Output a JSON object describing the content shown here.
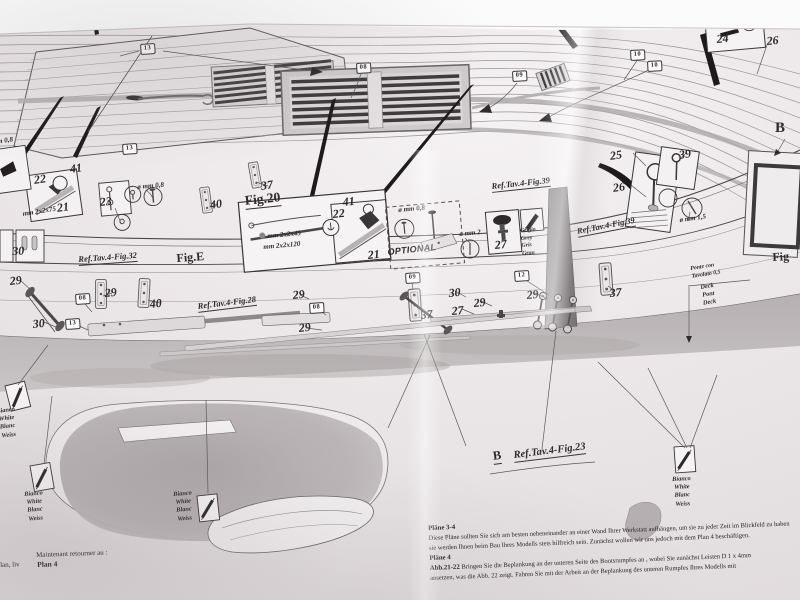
{
  "meta": {
    "description": "Photo of a model-ship construction plan sheet (Plan 3-4)"
  },
  "colors": {
    "background": "#fbfbfb",
    "paper": "#ece7e9",
    "paper_light": "#f5f2f3",
    "ink": "#3a3637",
    "grating_dark": "#3f3b3c",
    "hull_band_gray": "#b8b2b4",
    "shaded_blob_gray": "#b0aaac"
  },
  "labels": [
    {
      "t": "13",
      "x": 140,
      "y": 44,
      "rot": -4,
      "cls": "pbox"
    },
    {
      "t": "08",
      "x": 356,
      "y": 63,
      "rot": -3,
      "cls": "pbox"
    },
    {
      "t": "09",
      "x": 512,
      "y": 71,
      "rot": -3,
      "cls": "pbox"
    },
    {
      "t": "10",
      "x": 630,
      "y": 50,
      "rot": -3,
      "cls": "pbox"
    },
    {
      "t": "10",
      "x": 647,
      "y": 61,
      "rot": -3,
      "cls": "pbox"
    },
    {
      "t": "13",
      "x": 122,
      "y": 144,
      "rot": -4,
      "cls": "pbox"
    },
    {
      "t": "08",
      "x": 75,
      "y": 294,
      "rot": -4,
      "cls": "pbox"
    },
    {
      "t": "13",
      "x": 65,
      "y": 319,
      "rot": -4,
      "cls": "pbox"
    },
    {
      "t": "08",
      "x": 309,
      "y": 303,
      "rot": -4,
      "cls": "pbox"
    },
    {
      "t": "09",
      "x": 405,
      "y": 273,
      "rot": -4,
      "cls": "pbox"
    },
    {
      "t": "12",
      "x": 514,
      "y": 271,
      "rot": -4,
      "cls": "pbox"
    },
    {
      "t": "37",
      "x": 260,
      "y": 179,
      "rot": -8,
      "cls": "pnum"
    },
    {
      "t": "40",
      "x": 209,
      "y": 198,
      "rot": -8,
      "cls": "pnum"
    },
    {
      "t": "22",
      "x": 33,
      "y": 173,
      "rot": -8,
      "cls": "pnum"
    },
    {
      "t": "41",
      "x": 69,
      "y": 162,
      "rot": -8,
      "cls": "pnum"
    },
    {
      "t": "21",
      "x": 56,
      "y": 201,
      "rot": -8,
      "cls": "pnum"
    },
    {
      "t": "23",
      "x": 99,
      "y": 195,
      "rot": -6,
      "cls": "pnum"
    },
    {
      "t": "30",
      "x": 12,
      "y": 244,
      "rot": -2,
      "cls": "pnum"
    },
    {
      "t": "41",
      "x": 342,
      "y": 195,
      "rot": -6,
      "cls": "pnum"
    },
    {
      "t": "22",
      "x": 332,
      "y": 207,
      "rot": -6,
      "cls": "pnum"
    },
    {
      "t": "21",
      "x": 367,
      "y": 248,
      "rot": -6,
      "cls": "pnum"
    },
    {
      "t": "27",
      "x": 494,
      "y": 238,
      "rot": -6,
      "cls": "pnum"
    },
    {
      "t": "24",
      "x": 716,
      "y": 32,
      "rot": -5,
      "cls": "pnum"
    },
    {
      "t": "26",
      "x": 766,
      "y": 34,
      "rot": -5,
      "cls": "pnum"
    },
    {
      "t": "25",
      "x": 609,
      "y": 149,
      "rot": -8,
      "cls": "pnum"
    },
    {
      "t": "39",
      "x": 678,
      "y": 148,
      "rot": -8,
      "cls": "pnum"
    },
    {
      "t": "26",
      "x": 612,
      "y": 181,
      "rot": -8,
      "cls": "pnum"
    },
    {
      "t": "29",
      "x": 9,
      "y": 274,
      "rot": -6,
      "cls": "pnum"
    },
    {
      "t": "30",
      "x": 32,
      "y": 317,
      "rot": -6,
      "cls": "pnum"
    },
    {
      "t": "29",
      "x": 104,
      "y": 286,
      "rot": -6,
      "cls": "pnum"
    },
    {
      "t": "40",
      "x": 149,
      "y": 297,
      "rot": -6,
      "cls": "pnum"
    },
    {
      "t": "29",
      "x": 292,
      "y": 288,
      "rot": -6,
      "cls": "pnum"
    },
    {
      "t": "29",
      "x": 298,
      "y": 321,
      "rot": -6,
      "cls": "pnum"
    },
    {
      "t": "37",
      "x": 420,
      "y": 308,
      "rot": -5,
      "cls": "pnum"
    },
    {
      "t": "30",
      "x": 448,
      "y": 286,
      "rot": -5,
      "cls": "pnum"
    },
    {
      "t": "27",
      "x": 451,
      "y": 304,
      "rot": -5,
      "cls": "pnum"
    },
    {
      "t": "29",
      "x": 473,
      "y": 296,
      "rot": -5,
      "cls": "pnum"
    },
    {
      "t": "29",
      "x": 526,
      "y": 288,
      "rot": -5,
      "cls": "pnum"
    },
    {
      "t": "37",
      "x": 609,
      "y": 286,
      "rot": -5,
      "cls": "pnum"
    },
    {
      "t": "ø mm 0,8",
      "x": -14,
      "y": 139,
      "rot": -8,
      "cls": "dim"
    },
    {
      "t": "mm 2x2x75",
      "x": 22,
      "y": 210,
      "rot": -9,
      "cls": "dim"
    },
    {
      "t": "ø mm 0,8",
      "x": 137,
      "y": 183,
      "rot": -5,
      "cls": "dim"
    },
    {
      "t": "mm 2x2x45",
      "x": 267,
      "y": 232,
      "rot": -5,
      "cls": "dim"
    },
    {
      "t": "mm 2x2x120",
      "x": 263,
      "y": 243,
      "rot": -5,
      "cls": "dim"
    },
    {
      "t": "ø mm 0,8",
      "x": 398,
      "y": 206,
      "rot": -5,
      "cls": "dim"
    },
    {
      "t": "ø mm 2",
      "x": 459,
      "y": 230,
      "rot": -5,
      "cls": "dim"
    },
    {
      "t": "ø mm 1,5",
      "x": 679,
      "y": 216,
      "rot": -8,
      "cls": "dim"
    },
    {
      "t": "Ref.Tav.4-Fig.32",
      "x": 78,
      "y": 254,
      "rot": -4,
      "cls": "ref"
    },
    {
      "t": "Ref.Tav.4-Fig.28",
      "x": 197,
      "y": 301,
      "rot": -7,
      "cls": "ref"
    },
    {
      "t": "Ref.Tav.4-Fig.39",
      "x": 491,
      "y": 181,
      "rot": -6,
      "cls": "ref"
    },
    {
      "t": "Ref.Tav.4-Fig.39",
      "x": 576,
      "y": 226,
      "rot": -11,
      "cls": "ref"
    },
    {
      "t": "Ref.Tav.4-Fig.23",
      "x": 513,
      "y": 450,
      "rot": -7,
      "cls": "ref refbig"
    },
    {
      "t": "Fig.20",
      "x": 244,
      "y": 193,
      "rot": -6,
      "cls": "fig figu"
    },
    {
      "t": "Fig.E",
      "x": 176,
      "y": 251,
      "rot": -4,
      "cls": "fig"
    },
    {
      "t": "Fig",
      "x": 772,
      "y": 250,
      "rot": -3,
      "cls": "fig"
    },
    {
      "t": "B",
      "x": 775,
      "y": 120,
      "rot": 0,
      "cls": "fig bbig"
    },
    {
      "t": "B",
      "x": 492,
      "y": 449,
      "rot": -7,
      "cls": "fig bmid"
    },
    {
      "t": "OPTIONAL",
      "x": 387,
      "y": 247,
      "rot": -6,
      "cls": "opt"
    },
    {
      "t": "Grigio\nGrey\nGris\nGrau",
      "x": 520,
      "y": 228,
      "rot": -5,
      "cls": "colorlbl tleft small"
    },
    {
      "t": "Bianco\nWhite\nBlanc\nWeiss",
      "x": -4,
      "y": 408,
      "rot": -7,
      "cls": "colorlbl"
    },
    {
      "t": "Bianco\nWhite\nBlanc\nWeiss",
      "x": 24,
      "y": 491,
      "rot": -5,
      "cls": "colorlbl"
    },
    {
      "t": "Bianco\nWhite\nBlanc\nWeiss",
      "x": 173,
      "y": 491,
      "rot": -5,
      "cls": "colorlbl"
    },
    {
      "t": "Bianco\nWhite\nBlanc\nWeiss",
      "x": 672,
      "y": 476,
      "rot": -3,
      "cls": "colorlbl"
    },
    {
      "t": "Ponte con\nTavolato 0,5",
      "x": 690,
      "y": 266,
      "rot": -9,
      "cls": "colorlbl tleft small"
    },
    {
      "t": "Deck\nPont\nDeck",
      "x": 700,
      "y": 284,
      "rot": -9,
      "cls": "colorlbl"
    },
    {
      "t": "Maintenant retourner au :",
      "x": 36,
      "y": 551,
      "rot": -2,
      "cls": "note"
    },
    {
      "t": "Plan 4",
      "x": 37,
      "y": 560,
      "rot": -2,
      "cls": "note nbold"
    },
    {
      "t": "lan, liv",
      "x": 0,
      "y": 561,
      "rot": -2,
      "cls": "note"
    }
  ],
  "bottom_text": {
    "t1": "Pläne 3-4",
    "l1": "Diese Pläne sollten Sie sich am besten nebeneinander an einer Wand Ihrer Werkstatt aufhängen, um sie zu jeder Zeit im Blickfeld zu haben",
    "l2": "sie werden Ihnen beim Bau Ihres Modells stets hilfreich sein. Zunächst wollen wir uns jedoch mit dem Plan 4 beschäftigen.",
    "t2": "Pläne 4",
    "l3b": "Abb.21-22",
    "l3": " Bringen Sie die Beplankung an der unteren Seite des Bootsrumpfes an , wobei Sie zunächst Leisten D 1 x 4mm",
    "l4": "ansetzen, was die Abb. 22 zeigt. Fahren Sie mit der Arbeit an der Beplankung des unteren Rumpfes Ihres Modells mit"
  }
}
